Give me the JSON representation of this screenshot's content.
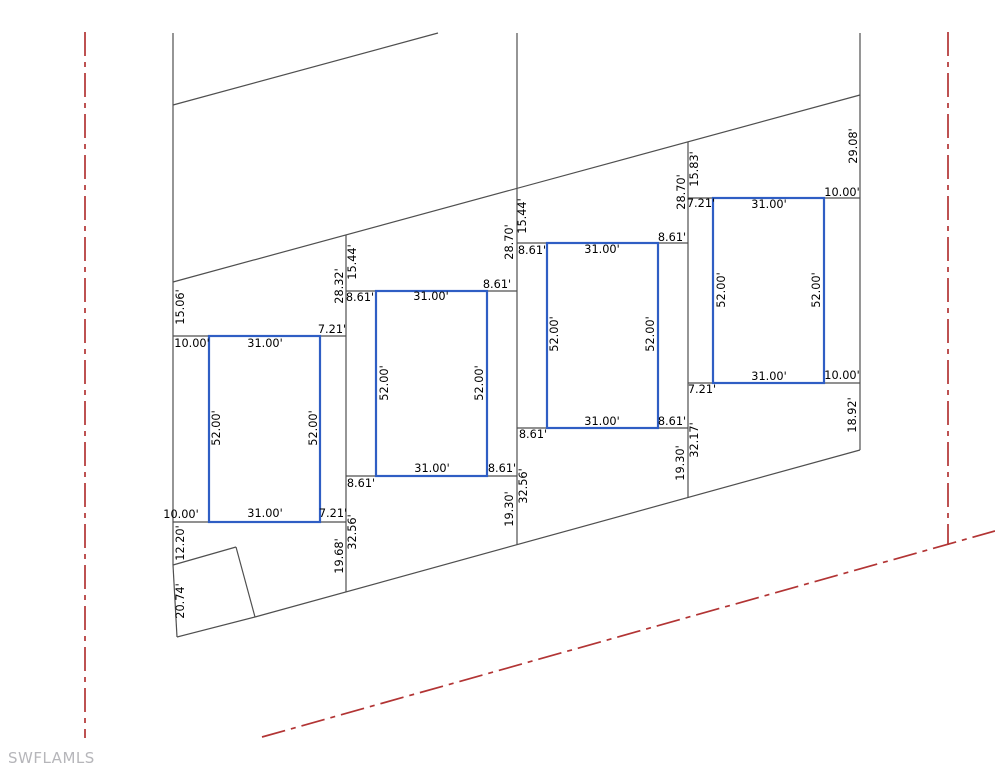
{
  "canvas": {
    "width": 995,
    "height": 768,
    "background": "#ffffff"
  },
  "watermark": {
    "text": "SWFLAMLS"
  },
  "colors": {
    "parcel_line": "#4f4f4f",
    "building_outline": "#2f5ec4",
    "centerline": "#b23434",
    "dimension_text": "#000000",
    "watermark_text": "#b6b6ba"
  },
  "drawing": {
    "parcel_lines": [
      {
        "name": "west-boundary",
        "x1": 173,
        "y1": 33,
        "x2": 173,
        "y2": 565
      },
      {
        "name": "west-boundary-lower",
        "x1": 173,
        "y1": 565,
        "x2": 177,
        "y2": 637
      },
      {
        "name": "southwest-corner-edge",
        "x1": 177,
        "y1": 637,
        "x2": 255,
        "y2": 617
      },
      {
        "name": "south-boundary-diagonal",
        "x1": 255,
        "y1": 617,
        "x2": 860,
        "y2": 450
      },
      {
        "name": "lot-line-1-2",
        "x1": 346,
        "y1": 235,
        "x2": 346,
        "y2": 592
      },
      {
        "name": "lot-line-2-3",
        "x1": 517,
        "y1": 33,
        "x2": 517,
        "y2": 545
      },
      {
        "name": "lot-line-3-4",
        "x1": 688,
        "y1": 142,
        "x2": 688,
        "y2": 498
      },
      {
        "name": "east-boundary",
        "x1": 860,
        "y1": 33,
        "x2": 860,
        "y2": 450
      },
      {
        "name": "north-diagonal-upper",
        "x1": 173,
        "y1": 105,
        "x2": 438,
        "y2": 33
      },
      {
        "name": "north-diagonal",
        "x1": 173,
        "y1": 282,
        "x2": 860,
        "y2": 95
      },
      {
        "name": "corner-parcel-edge-north",
        "x1": 173,
        "y1": 565,
        "x2": 236,
        "y2": 547
      },
      {
        "name": "corner-parcel-edge-east",
        "x1": 236,
        "y1": 547,
        "x2": 255,
        "y2": 617
      },
      {
        "name": "lot1-setback-top",
        "x1": 173,
        "y1": 336,
        "x2": 346,
        "y2": 336
      },
      {
        "name": "lot1-setback-bottom",
        "x1": 173,
        "y1": 522,
        "x2": 346,
        "y2": 522
      },
      {
        "name": "lot2-setback-top",
        "x1": 346,
        "y1": 291,
        "x2": 517,
        "y2": 291
      },
      {
        "name": "lot2-setback-bottom",
        "x1": 346,
        "y1": 476,
        "x2": 517,
        "y2": 476
      },
      {
        "name": "lot3-setback-top",
        "x1": 517,
        "y1": 243,
        "x2": 688,
        "y2": 243
      },
      {
        "name": "lot3-setback-bottom",
        "x1": 517,
        "y1": 428,
        "x2": 688,
        "y2": 428
      },
      {
        "name": "lot4-setback-top",
        "x1": 688,
        "y1": 198,
        "x2": 860,
        "y2": 198
      },
      {
        "name": "lot4-setback-bottom",
        "x1": 688,
        "y1": 383,
        "x2": 860,
        "y2": 383
      }
    ],
    "centerlines": [
      {
        "name": "west-road-centerline",
        "x1": 85,
        "y1": 32,
        "x2": 85,
        "y2": 738
      },
      {
        "name": "east-road-centerline",
        "x1": 948,
        "y1": 32,
        "x2": 948,
        "y2": 545
      },
      {
        "name": "south-road-centerline",
        "x1": 262,
        "y1": 737,
        "x2": 995,
        "y2": 531
      }
    ],
    "buildings": [
      {
        "name": "building-footprint-lot1",
        "x": 209,
        "y": 336,
        "w": 111,
        "h": 186
      },
      {
        "name": "building-footprint-lot2",
        "x": 376,
        "y": 291,
        "w": 111,
        "h": 185
      },
      {
        "name": "building-footprint-lot3",
        "x": 547,
        "y": 243,
        "w": 111,
        "h": 185
      },
      {
        "name": "building-footprint-lot4",
        "x": 713,
        "y": 198,
        "w": 111,
        "h": 185
      }
    ],
    "dimensions": [
      {
        "text": "10.00'",
        "x": 192,
        "y": 344,
        "rot": 0
      },
      {
        "text": "31.00'",
        "x": 265,
        "y": 344,
        "rot": 0
      },
      {
        "text": "7.21'",
        "x": 332,
        "y": 330,
        "rot": 0
      },
      {
        "text": "10.00'",
        "x": 181,
        "y": 515,
        "rot": 0
      },
      {
        "text": "31.00'",
        "x": 265,
        "y": 514,
        "rot": 0
      },
      {
        "text": "7.21'",
        "x": 333,
        "y": 514,
        "rot": 0
      },
      {
        "text": "52.00'",
        "x": 217,
        "y": 428,
        "rot": -90
      },
      {
        "text": "52.00'",
        "x": 314,
        "y": 428,
        "rot": -90
      },
      {
        "text": "15.06'",
        "x": 181,
        "y": 307,
        "rot": -90
      },
      {
        "text": "12.20'",
        "x": 181,
        "y": 543,
        "rot": -90
      },
      {
        "text": "20.74'",
        "x": 181,
        "y": 601,
        "rot": -90
      },
      {
        "text": "28.32'",
        "x": 340,
        "y": 286,
        "rot": -90
      },
      {
        "text": "15.44'",
        "x": 353,
        "y": 262,
        "rot": -90
      },
      {
        "text": "19.68'",
        "x": 340,
        "y": 556,
        "rot": -90
      },
      {
        "text": "32.56'",
        "x": 353,
        "y": 532,
        "rot": -90
      },
      {
        "text": "8.61'",
        "x": 360,
        "y": 298,
        "rot": 0
      },
      {
        "text": "31.00'",
        "x": 431,
        "y": 297,
        "rot": 0
      },
      {
        "text": "8.61'",
        "x": 497,
        "y": 285,
        "rot": 0
      },
      {
        "text": "8.61'",
        "x": 361,
        "y": 484,
        "rot": 0
      },
      {
        "text": "31.00'",
        "x": 432,
        "y": 469,
        "rot": 0
      },
      {
        "text": "8.61'",
        "x": 502,
        "y": 469,
        "rot": 0
      },
      {
        "text": "52.00'",
        "x": 385,
        "y": 383,
        "rot": -90
      },
      {
        "text": "52.00'",
        "x": 480,
        "y": 383,
        "rot": -90
      },
      {
        "text": "28.70'",
        "x": 510,
        "y": 242,
        "rot": -90
      },
      {
        "text": "15.44'",
        "x": 523,
        "y": 216,
        "rot": -90
      },
      {
        "text": "19.30'",
        "x": 510,
        "y": 509,
        "rot": -90
      },
      {
        "text": "32.56'",
        "x": 524,
        "y": 486,
        "rot": -90
      },
      {
        "text": "8.61'",
        "x": 532,
        "y": 251,
        "rot": 0
      },
      {
        "text": "31.00'",
        "x": 602,
        "y": 250,
        "rot": 0
      },
      {
        "text": "8.61'",
        "x": 672,
        "y": 238,
        "rot": 0
      },
      {
        "text": "8.61'",
        "x": 533,
        "y": 435,
        "rot": 0
      },
      {
        "text": "31.00'",
        "x": 602,
        "y": 422,
        "rot": 0
      },
      {
        "text": "8.61'",
        "x": 672,
        "y": 422,
        "rot": 0
      },
      {
        "text": "52.00'",
        "x": 555,
        "y": 334,
        "rot": -90
      },
      {
        "text": "52.00'",
        "x": 651,
        "y": 334,
        "rot": -90
      },
      {
        "text": "28.70'",
        "x": 682,
        "y": 192,
        "rot": -90
      },
      {
        "text": "15.83'",
        "x": 695,
        "y": 169,
        "rot": -90
      },
      {
        "text": "19.30'",
        "x": 681,
        "y": 463,
        "rot": -90
      },
      {
        "text": "32.17'",
        "x": 695,
        "y": 440,
        "rot": -90
      },
      {
        "text": "7.21'",
        "x": 701,
        "y": 204,
        "rot": 0
      },
      {
        "text": "31.00'",
        "x": 769,
        "y": 205,
        "rot": 0
      },
      {
        "text": "10.00'",
        "x": 842,
        "y": 193,
        "rot": 0
      },
      {
        "text": "7.21'",
        "x": 702,
        "y": 390,
        "rot": 0
      },
      {
        "text": "31.00'",
        "x": 769,
        "y": 377,
        "rot": 0
      },
      {
        "text": "10.00'",
        "x": 842,
        "y": 376,
        "rot": 0
      },
      {
        "text": "52.00'",
        "x": 722,
        "y": 290,
        "rot": -90
      },
      {
        "text": "52.00'",
        "x": 817,
        "y": 290,
        "rot": -90
      },
      {
        "text": "29.08'",
        "x": 854,
        "y": 146,
        "rot": -90
      },
      {
        "text": "18.92'",
        "x": 853,
        "y": 415,
        "rot": -90
      }
    ]
  }
}
